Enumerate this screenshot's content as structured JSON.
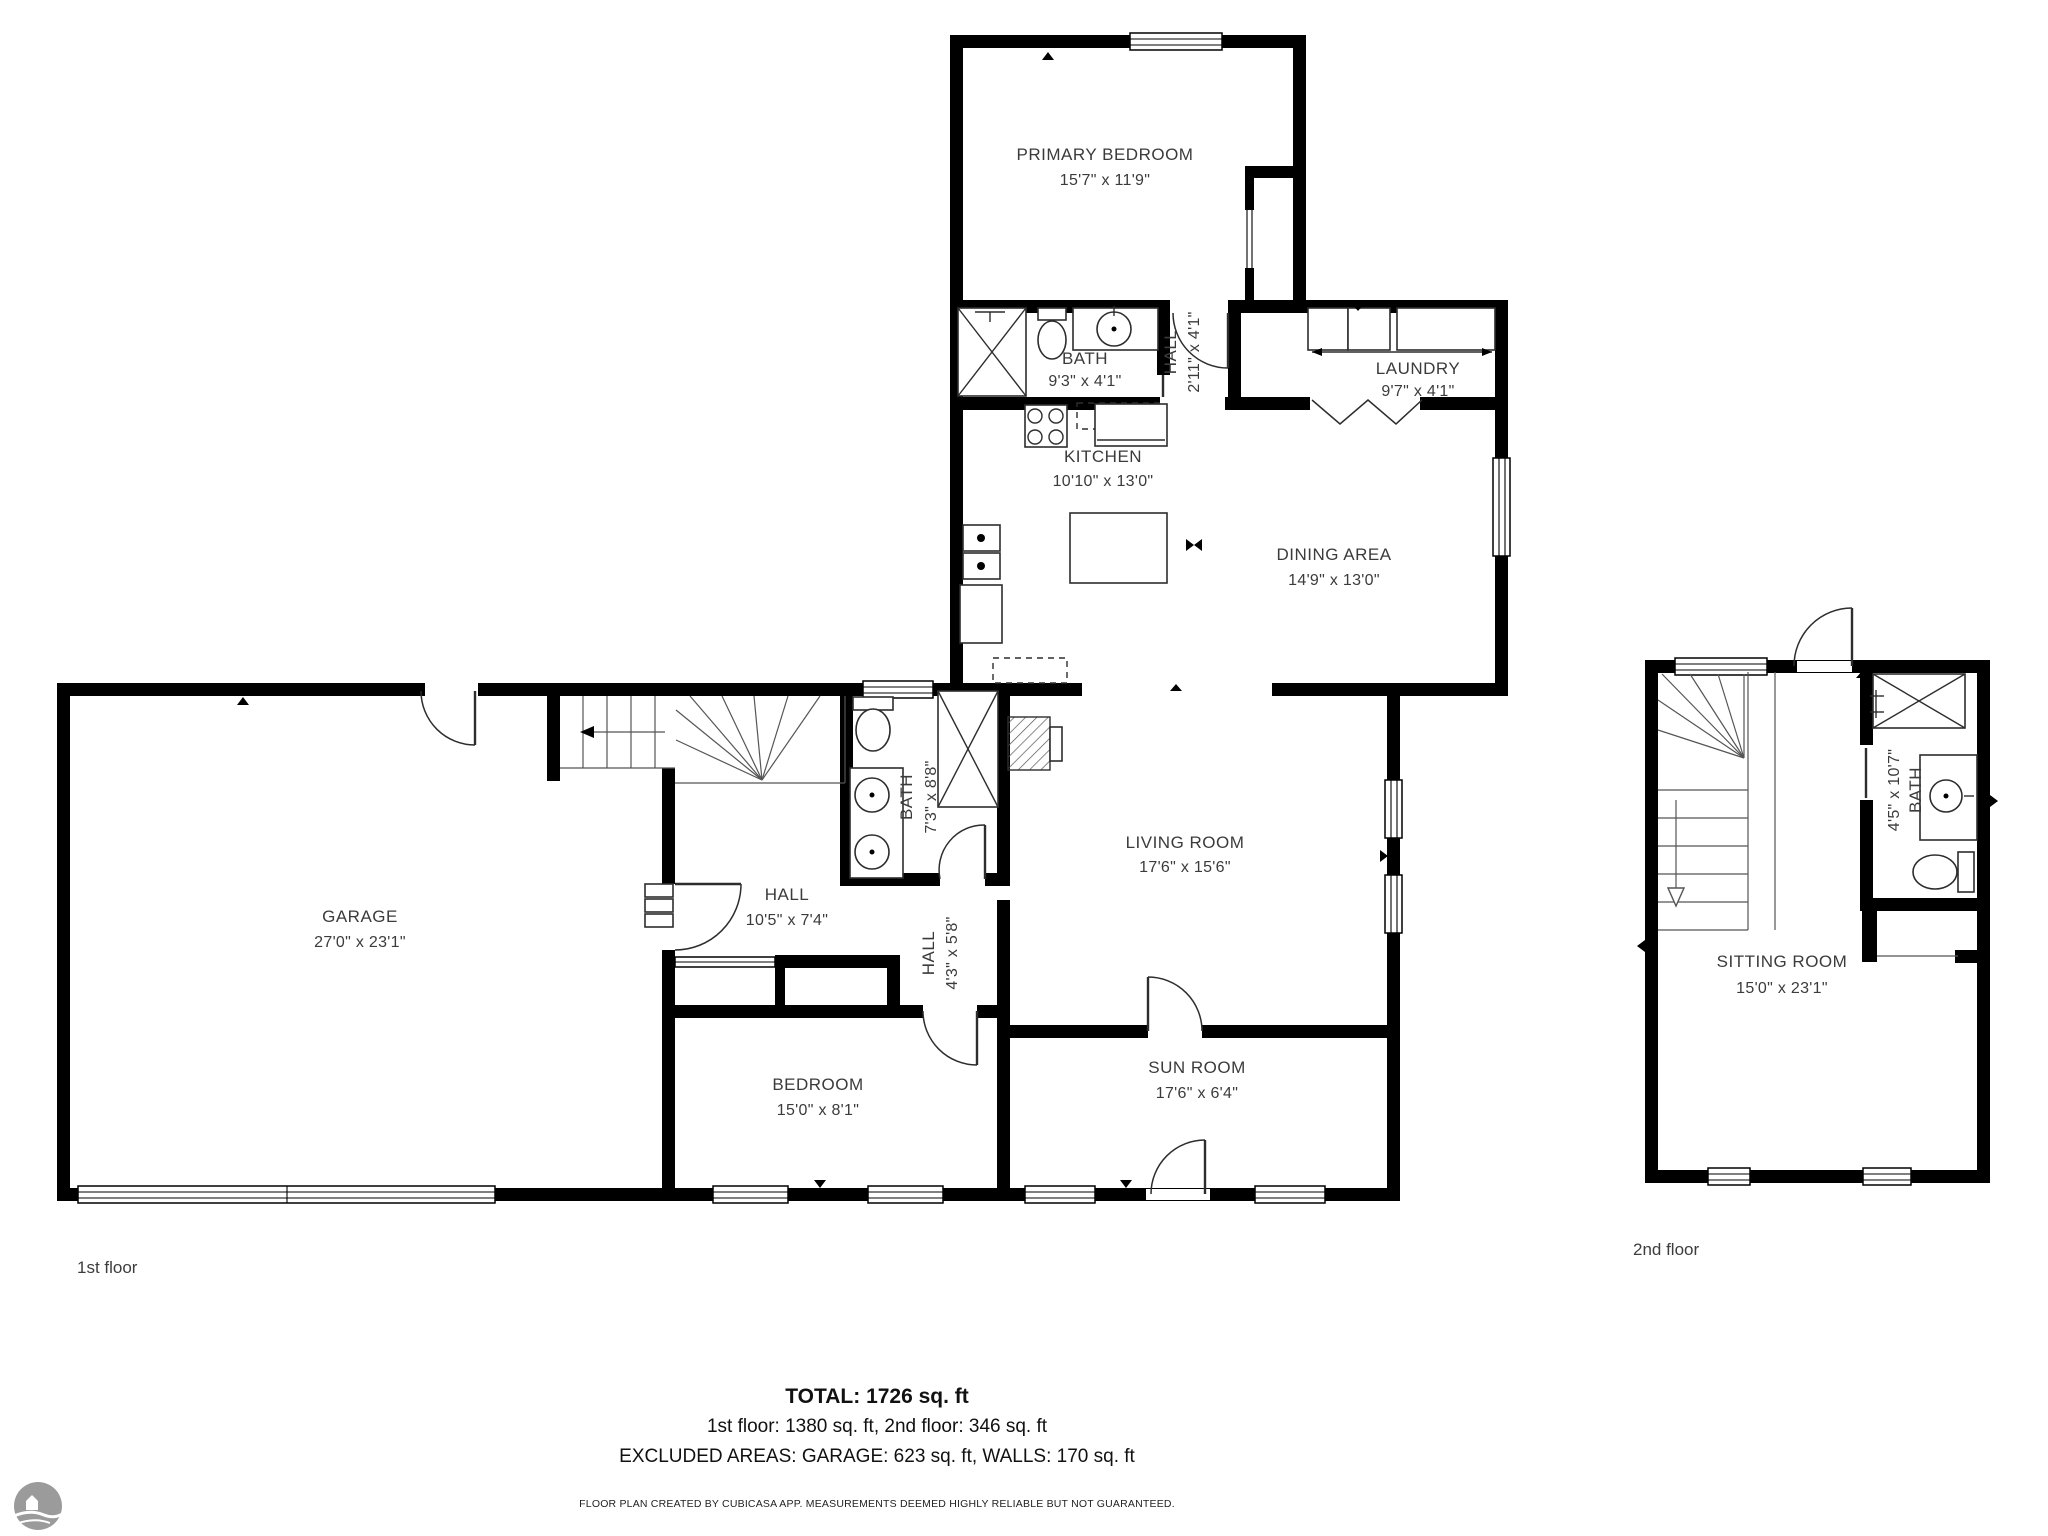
{
  "rooms": {
    "primary_bedroom": {
      "name": "PRIMARY BEDROOM",
      "dims": "15'7\" x 11'9\""
    },
    "bath_upper": {
      "name": "BATH",
      "dims": "9'3\" x 4'1\""
    },
    "hall_upper": {
      "name": "HALL",
      "dims": "2'11\" x 4'1\""
    },
    "laundry": {
      "name": "LAUNDRY",
      "dims": "9'7\" x 4'1\""
    },
    "kitchen": {
      "name": "KITCHEN",
      "dims": "10'10\" x 13'0\""
    },
    "dining": {
      "name": "DINING AREA",
      "dims": "14'9\" x 13'0\""
    },
    "garage": {
      "name": "GARAGE",
      "dims": "27'0\" x 23'1\""
    },
    "hall_main": {
      "name": "HALL",
      "dims": "10'5\" x 7'4\""
    },
    "bath_main": {
      "name": "BATH",
      "dims": "7'3\" x 8'8\""
    },
    "hall_small": {
      "name": "HALL",
      "dims": "4'3\" x 5'8\""
    },
    "bedroom": {
      "name": "BEDROOM",
      "dims": "15'0\" x 8'1\""
    },
    "living": {
      "name": "LIVING ROOM",
      "dims": "17'6\" x 15'6\""
    },
    "sunroom": {
      "name": "SUN ROOM",
      "dims": "17'6\" x 6'4\""
    },
    "bath_second": {
      "name": "BATH",
      "dims": "4'5\" x 10'7\""
    },
    "sitting": {
      "name": "SITTING ROOM",
      "dims": "15'0\" x 23'1\""
    }
  },
  "floor_labels": {
    "first": "1st floor",
    "second": "2nd floor"
  },
  "summary": {
    "total": "TOTAL: 1726 sq. ft",
    "floors": "1st floor: 1380 sq. ft, 2nd floor: 346 sq. ft",
    "excluded": "EXCLUDED AREAS: GARAGE: 623 sq. ft, WALLS: 170 sq. ft",
    "disclaimer": "FLOOR PLAN CREATED BY CUBICASA APP. MEASUREMENTS DEEMED HIGHLY RELIABLE BUT NOT GUARANTEED."
  },
  "colors": {
    "wall": "#000000",
    "text": "#3b3b3b",
    "logo": "#9b9b9b"
  }
}
